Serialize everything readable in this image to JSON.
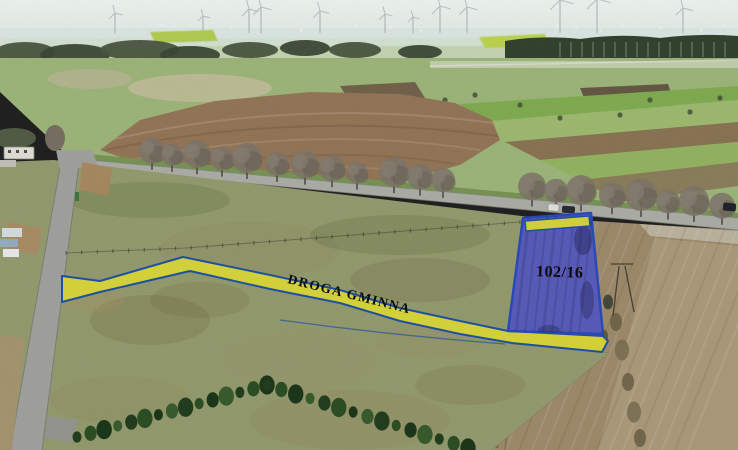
{
  "image": {
    "kind": "aerial-drone-photograph-of-land-parcel",
    "overlays": {
      "road_strip_label": "DROGA GMINNA",
      "parcel_label": "102/16"
    },
    "colors": {
      "overlay_yellow": "#e5e23a",
      "overlay_blue_border": "#2156aa",
      "parcel_fill": "#575cc6",
      "parcel_border": "#2b4ec5",
      "label_text_color": "#0d0d0d"
    }
  }
}
